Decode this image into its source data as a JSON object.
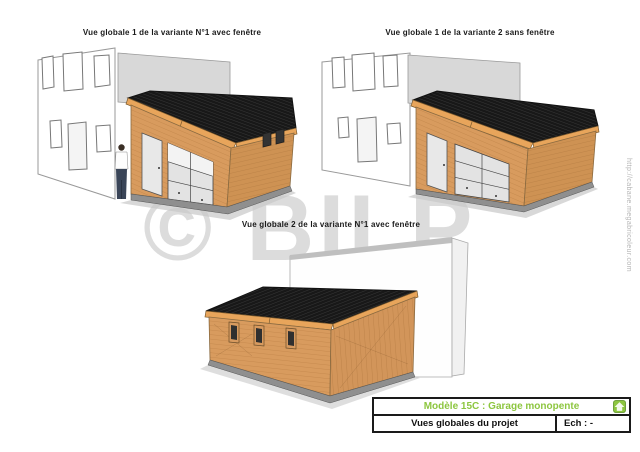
{
  "page": {
    "views": [
      {
        "id": "view1",
        "caption": "Vue globale 1 de la variante N°1 avec fenêtre"
      },
      {
        "id": "view2",
        "caption": "Vue globale 1 de la variante 2 sans fenêtre"
      },
      {
        "id": "view3",
        "caption": "Vue globale 2 de la variante N°1 avec fenêtre"
      }
    ],
    "watermark": {
      "logo": "© BILP",
      "url": "http://cabane.megabricoleur.com"
    },
    "title_block": {
      "model_title": "Modèle 15C : Garage monopente",
      "sheet_title": "Vues globales du projet",
      "scale_label": "Ech : -",
      "accent_color": "#8DC63F"
    },
    "colors": {
      "wood": "#D89B5E",
      "wood_shade": "#CE9253",
      "fascia": "#E8A55B",
      "roof": "#181818",
      "house_gray": "#D8D8D8",
      "slab_gray": "#8F8F8F",
      "shadow_gray": "#C8C8C8"
    }
  }
}
